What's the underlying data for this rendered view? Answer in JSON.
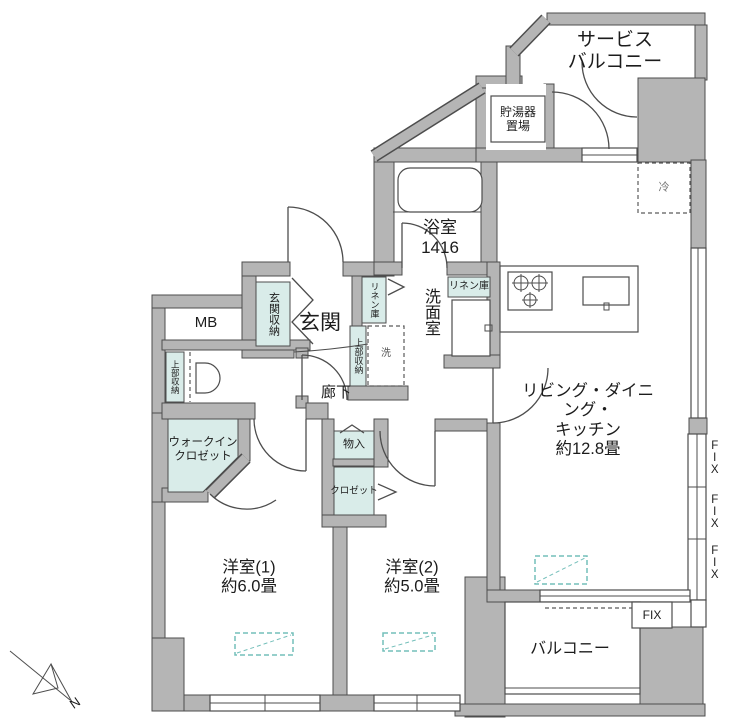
{
  "labels": {
    "service_balcony": "サービス\nバルコニー",
    "water_heater": "貯湯器\n置場",
    "bathroom": "浴室\n1416",
    "washroom": "洗面室",
    "linen_left": "リネン庫",
    "linen_right": "リネン庫",
    "upper_storage_laundry": "上部収納",
    "washer": "洗",
    "entrance": "玄関",
    "entrance_storage": "玄関収納",
    "mb": "MB",
    "upper_storage_toilet": "上部収納",
    "corridor": "廊下",
    "ldk": "リビング・ダイニング・\nキッチン\n約12.8畳",
    "fridge": "冷",
    "walk_in_closet": "ウォークイン\nクロゼット",
    "storage": "物入",
    "closet": "クロゼット",
    "bedroom1": "洋室(1)\n約6.0畳",
    "bedroom2": "洋室(2)\n約5.0畳",
    "balcony": "バルコニー",
    "fix_horizontal": "FIX",
    "fix_vertical_1": "FIX",
    "fix_vertical_2": "FIX",
    "fix_vertical_3": "FIX",
    "compass_north": "N"
  },
  "colors": {
    "wall_gray": "#b5b5b5",
    "line_dark": "#4d4d4d",
    "storage_teal": "#d9ece9",
    "furniture_marker_teal": "#74bfba"
  }
}
